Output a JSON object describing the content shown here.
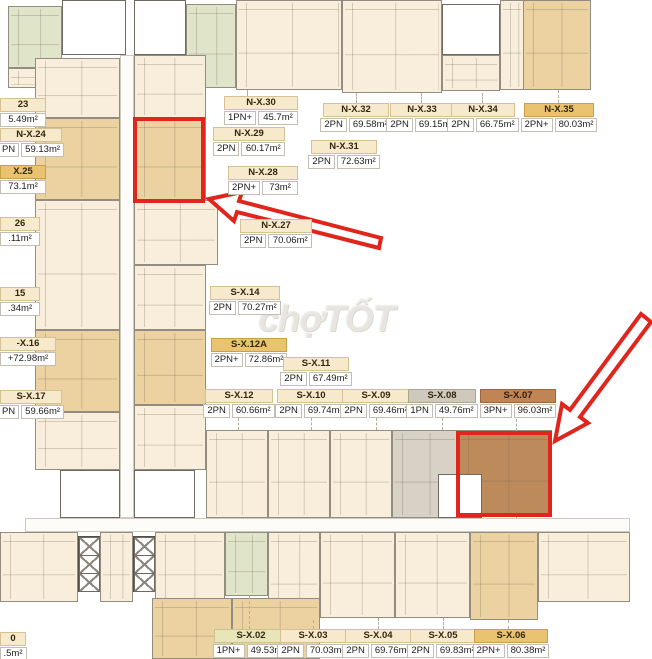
{
  "watermark": {
    "text": "chợTỐT"
  },
  "annotation_colors": {
    "highlight_red": "#e0251c"
  },
  "unit_fill_colors": {
    "cream": "#f8eedb",
    "tan": "#ecd2a0",
    "green": "#e0e4c8",
    "gray": "#d7d1c6",
    "brown": "#bd8a5c",
    "core": "#ffffff"
  },
  "units": [
    {
      "x": 8,
      "y": 6,
      "w": 54,
      "h": 62,
      "f": "green"
    },
    {
      "x": 8,
      "y": 68,
      "w": 54,
      "h": 20,
      "f": "cream"
    },
    {
      "x": 62,
      "y": 0,
      "w": 64,
      "h": 55,
      "f": "core"
    },
    {
      "x": 134,
      "y": 0,
      "w": 52,
      "h": 55,
      "f": "core"
    },
    {
      "x": 186,
      "y": 4,
      "w": 50,
      "h": 84,
      "f": "green"
    },
    {
      "x": 236,
      "y": 0,
      "w": 106,
      "h": 90,
      "f": "cream"
    },
    {
      "x": 342,
      "y": 0,
      "w": 100,
      "h": 93,
      "f": "cream"
    },
    {
      "x": 442,
      "y": 55,
      "w": 58,
      "h": 36,
      "f": "cream"
    },
    {
      "x": 442,
      "y": 4,
      "w": 58,
      "h": 51,
      "f": "core"
    },
    {
      "x": 500,
      "y": 0,
      "w": 24,
      "h": 90,
      "f": "cream"
    },
    {
      "x": 523,
      "y": 0,
      "w": 68,
      "h": 90,
      "f": "tan"
    },
    {
      "x": 35,
      "y": 58,
      "w": 85,
      "h": 60,
      "f": "cream"
    },
    {
      "x": 35,
      "y": 118,
      "w": 85,
      "h": 82,
      "f": "tan"
    },
    {
      "x": 35,
      "y": 200,
      "w": 85,
      "h": 130,
      "f": "cream"
    },
    {
      "x": 35,
      "y": 330,
      "w": 85,
      "h": 82,
      "f": "tan"
    },
    {
      "x": 35,
      "y": 412,
      "w": 85,
      "h": 58,
      "f": "cream"
    },
    {
      "x": 134,
      "y": 55,
      "w": 72,
      "h": 63,
      "f": "cream"
    },
    {
      "x": 134,
      "y": 118,
      "w": 72,
      "h": 82,
      "f": "tan"
    },
    {
      "x": 134,
      "y": 200,
      "w": 84,
      "h": 65,
      "f": "cream"
    },
    {
      "x": 134,
      "y": 265,
      "w": 72,
      "h": 65,
      "f": "cream"
    },
    {
      "x": 134,
      "y": 330,
      "w": 72,
      "h": 75,
      "f": "tan"
    },
    {
      "x": 134,
      "y": 405,
      "w": 72,
      "h": 65,
      "f": "cream"
    },
    {
      "x": 120,
      "y": 55,
      "w": 14,
      "h": 463,
      "f": "corridor"
    },
    {
      "x": 60,
      "y": 470,
      "w": 60,
      "h": 48,
      "f": "core"
    },
    {
      "x": 134,
      "y": 470,
      "w": 61,
      "h": 48,
      "f": "core"
    },
    {
      "x": 206,
      "y": 430,
      "w": 62,
      "h": 88,
      "f": "cream"
    },
    {
      "x": 268,
      "y": 430,
      "w": 62,
      "h": 88,
      "f": "cream"
    },
    {
      "x": 330,
      "y": 430,
      "w": 62,
      "h": 88,
      "f": "cream"
    },
    {
      "x": 392,
      "y": 430,
      "w": 66,
      "h": 88,
      "f": "gray"
    },
    {
      "x": 458,
      "y": 430,
      "w": 94,
      "h": 86,
      "f": "brown"
    },
    {
      "x": 438,
      "y": 474,
      "w": 44,
      "h": 44,
      "f": "core"
    },
    {
      "x": 25,
      "y": 518,
      "w": 605,
      "h": 14,
      "f": "corridor"
    },
    {
      "x": 0,
      "y": 532,
      "w": 78,
      "h": 70,
      "f": "cream"
    },
    {
      "x": 100,
      "y": 532,
      "w": 33,
      "h": 70,
      "f": "cream"
    },
    {
      "x": 155,
      "y": 532,
      "w": 70,
      "h": 70,
      "f": "cream"
    },
    {
      "x": 78,
      "y": 536,
      "w": 22,
      "h": 56,
      "f": "shaft"
    },
    {
      "x": 133,
      "y": 536,
      "w": 22,
      "h": 56,
      "f": "shaft"
    },
    {
      "x": 225,
      "y": 532,
      "w": 43,
      "h": 64,
      "f": "green"
    },
    {
      "x": 268,
      "y": 532,
      "w": 52,
      "h": 88,
      "f": "cream"
    },
    {
      "x": 320,
      "y": 532,
      "w": 75,
      "h": 86,
      "f": "cream"
    },
    {
      "x": 395,
      "y": 532,
      "w": 75,
      "h": 86,
      "f": "cream"
    },
    {
      "x": 470,
      "y": 532,
      "w": 68,
      "h": 88,
      "f": "tan"
    },
    {
      "x": 538,
      "y": 532,
      "w": 92,
      "h": 70,
      "f": "cream"
    },
    {
      "x": 152,
      "y": 598,
      "w": 80,
      "h": 61,
      "f": "tan"
    },
    {
      "x": 232,
      "y": 598,
      "w": 88,
      "h": 61,
      "f": "tan"
    }
  ],
  "labels": [
    {
      "name": "N-X.30",
      "type": "1PN+",
      "area": "45.7m²",
      "x": 224,
      "y": 96,
      "w": 74
    },
    {
      "name": "N-X.29",
      "type": "2PN",
      "area": "60.17m²",
      "x": 213,
      "y": 127,
      "w": 72
    },
    {
      "name": "N-X.28",
      "type": "2PN+",
      "area": "73m²",
      "x": 228,
      "y": 166,
      "w": 70
    },
    {
      "name": "N-X.27",
      "type": "2PN",
      "area": "70.06m²",
      "x": 240,
      "y": 219,
      "w": 72
    },
    {
      "name": "N-X.31",
      "type": "2PN",
      "area": "72.63m²",
      "x": 311,
      "y": 140,
      "w": 66
    },
    {
      "name": "N-X.32",
      "type": "2PN",
      "area": "69.58m²",
      "x": 323,
      "y": 103,
      "w": 66
    },
    {
      "name": "N-X.33",
      "type": "2PN",
      "area": "69.15m²",
      "x": 390,
      "y": 103,
      "w": 64
    },
    {
      "name": "N-X.34",
      "type": "2PN",
      "area": "66.75m²",
      "x": 451,
      "y": 103,
      "w": 64
    },
    {
      "name": "N-X.35",
      "type": "2PN+",
      "area": "80.03m²",
      "x": 524,
      "y": 103,
      "w": 70,
      "v": "dark"
    },
    {
      "name": "S-X.14",
      "type": "2PN",
      "area": "70.27m²",
      "x": 210,
      "y": 286,
      "w": 70
    },
    {
      "name": "S-X.12A",
      "type": "2PN+",
      "area": "72.86m²",
      "x": 211,
      "y": 338,
      "w": 76,
      "v": "dark"
    },
    {
      "name": "S-X.11",
      "type": "2PN",
      "area": "67.49m²",
      "x": 283,
      "y": 357,
      "w": 66
    },
    {
      "name": "S-X.12",
      "type": "2PN",
      "area": "60.66m²",
      "x": 205,
      "y": 389,
      "w": 68
    },
    {
      "name": "S-X.10",
      "type": "2PN",
      "area": "69.74m²",
      "x": 277,
      "y": 389,
      "w": 68
    },
    {
      "name": "S-X.09",
      "type": "2PN",
      "area": "69.46m²",
      "x": 342,
      "y": 389,
      "w": 68
    },
    {
      "name": "S-X.08",
      "type": "1PN",
      "area": "49.76m²",
      "x": 408,
      "y": 389,
      "w": 68,
      "v": "gray"
    },
    {
      "name": "S-X.07",
      "type": "3PN+",
      "area": "96.03m²",
      "x": 480,
      "y": 389,
      "w": 76,
      "v": "brown"
    },
    {
      "name": "S-X.02",
      "type": "1PN+",
      "area": "49.53m²",
      "x": 214,
      "y": 629,
      "w": 74,
      "v": "green"
    },
    {
      "name": "S-X.03",
      "type": "2PN",
      "area": "70.03m²",
      "x": 280,
      "y": 629,
      "w": 66
    },
    {
      "name": "S-X.04",
      "type": "2PN",
      "area": "69.76m²",
      "x": 345,
      "y": 629,
      "w": 66
    },
    {
      "name": "S-X.05",
      "type": "2PN",
      "area": "69.83m²",
      "x": 410,
      "y": 629,
      "w": 66
    },
    {
      "name": "S-X.06",
      "type": "2PN+",
      "area": "80.38m²",
      "x": 474,
      "y": 629,
      "w": 74,
      "v": "dark"
    },
    {
      "name": "23",
      "type": "",
      "area": "5.49m²",
      "x": 0,
      "y": 98,
      "w": 46
    },
    {
      "name": "N-X.24",
      "type": "PN",
      "area": "59.13m²",
      "x": 0,
      "y": 128,
      "w": 62
    },
    {
      "name": "X.25",
      "type": "",
      "area": "73.1m²",
      "x": 0,
      "y": 165,
      "w": 46,
      "v": "dark"
    },
    {
      "name": "26",
      "type": "",
      "area": ".11m²",
      "x": 0,
      "y": 217,
      "w": 40
    },
    {
      "name": "15",
      "type": "",
      "area": ".34m²",
      "x": 0,
      "y": 287,
      "w": 40
    },
    {
      "name": "-X.16",
      "type": "",
      "area": "+72.98m²",
      "x": 0,
      "y": 337,
      "w": 56
    },
    {
      "name": "S-X.17",
      "type": "PN",
      "area": "59.66m²",
      "x": 0,
      "y": 390,
      "w": 62
    },
    {
      "name": "0",
      "type": "",
      "area": ".5m²",
      "x": 0,
      "y": 632,
      "w": 26
    }
  ],
  "leaders": [
    {
      "x": 247,
      "y1": 90,
      "y2": 96
    },
    {
      "x": 356,
      "y1": 93,
      "y2": 103
    },
    {
      "x": 421,
      "y1": 93,
      "y2": 103
    },
    {
      "x": 482,
      "y1": 93,
      "y2": 103
    },
    {
      "x": 558,
      "y1": 90,
      "y2": 103
    },
    {
      "x": 238,
      "y1": 418,
      "y2": 430
    },
    {
      "x": 311,
      "y1": 418,
      "y2": 430
    },
    {
      "x": 376,
      "y1": 418,
      "y2": 430
    },
    {
      "x": 442,
      "y1": 418,
      "y2": 430
    },
    {
      "x": 516,
      "y1": 419,
      "y2": 431
    },
    {
      "x": 516,
      "y1": 516,
      "y2": 532
    },
    {
      "x": 249,
      "y1": 596,
      "y2": 629
    },
    {
      "x": 313,
      "y1": 620,
      "y2": 629
    },
    {
      "x": 378,
      "y1": 618,
      "y2": 629
    },
    {
      "x": 443,
      "y1": 618,
      "y2": 629
    },
    {
      "x": 508,
      "y1": 620,
      "y2": 629
    }
  ],
  "highlight_boxes": [
    {
      "x": 133,
      "y": 117,
      "w": 72,
      "h": 86
    },
    {
      "x": 456,
      "y": 431,
      "w": 96,
      "h": 86
    }
  ],
  "arrows": [
    {
      "points": "209,199 242,192 239,201 381,238 379,248 237,212 234,221"
    },
    {
      "points": "555,441 562,404 570,410 641,314 651,322 580,417 588,423"
    }
  ]
}
